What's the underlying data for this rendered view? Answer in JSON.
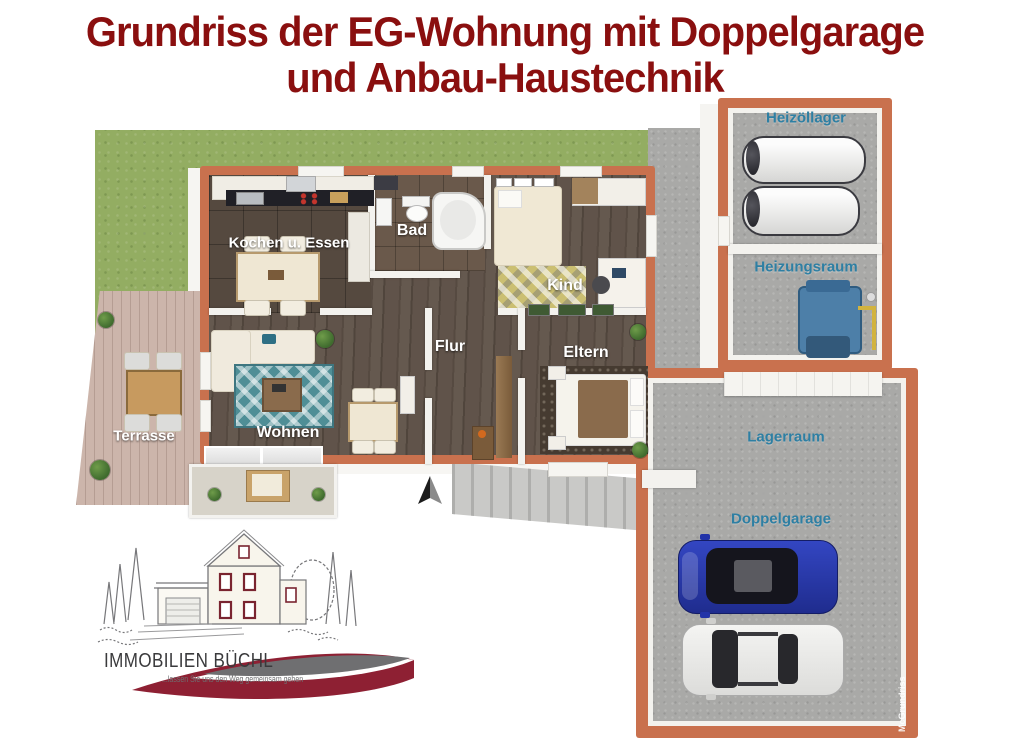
{
  "title": {
    "line1": "Grundriss der EG-Wohnung mit Doppelgarage",
    "line2": "und Anbau-Haustechnik",
    "color": "#8A0F0F"
  },
  "rooms": {
    "kochen": "Kochen u. Essen",
    "bad": "Bad",
    "kind": "Kind",
    "flur": "Flur",
    "eltern": "Eltern",
    "wohnen": "Wohnen",
    "terrasse": "Terrasse",
    "heizoellager": "Heizöllager",
    "heizungsraum": "Heizungsraum",
    "lagerraum": "Lagerraum",
    "doppelgarage": "Doppelgarage"
  },
  "label_styles": {
    "apartment_label_color": "#FFFFFF",
    "annex_label_color": "#2E7FA3"
  },
  "watermark": "McGrundriss",
  "logo": {
    "name": "IMMOBILIEN BÜCHL",
    "tagline": "...lassen Sie uns den Weg gemeinsam gehen"
  },
  "colors": {
    "title_red": "#8A0F0F",
    "wall_terracotta": "#C9714E",
    "inner_wall_white": "#F3F2EE",
    "grass_green": "#93AD62",
    "terrace_wood": "#CCB5AB",
    "apartment_floor_wood": "#5D5046",
    "concrete_gray": "#A9A9A7",
    "car_blue": "#2A3BB0",
    "car_white": "#EDEDEB",
    "logo_maroon": "#8E2033",
    "logo_gray": "#6F6F71"
  }
}
